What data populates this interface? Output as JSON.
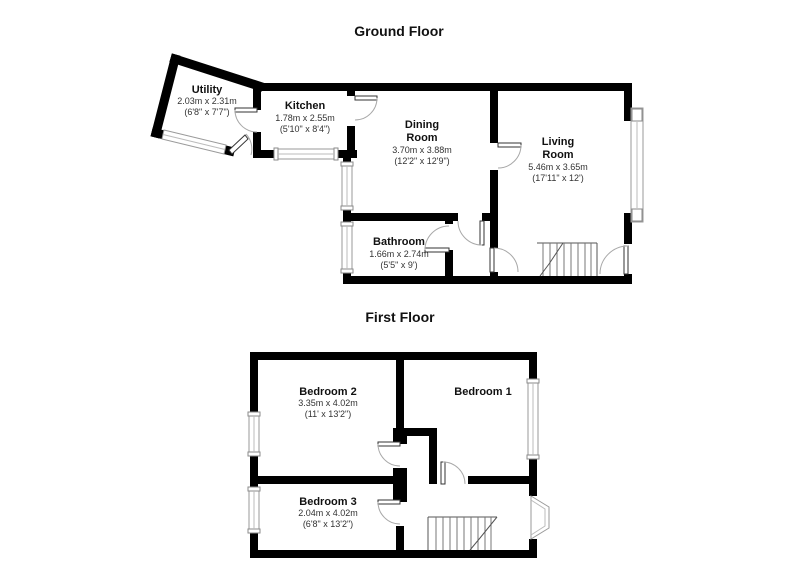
{
  "page": {
    "background": "#ffffff"
  },
  "colors": {
    "wall": "#000000",
    "window_outline": "#9a9a9a",
    "door_arc": "#a8a8a8",
    "stairs": "#555555",
    "room_name_text": "#111111",
    "dimension_text": "#333333"
  },
  "ground_floor": {
    "title": "Ground Floor",
    "rooms": {
      "utility": {
        "name": "Utility",
        "metric": "2.03m x 2.31m",
        "imperial": "(6'8\" x 7'7\")"
      },
      "kitchen": {
        "name": "Kitchen",
        "metric": "1.78m x 2.55m",
        "imperial": "(5'10\" x 8'4\")"
      },
      "dining": {
        "name_line1": "Dining",
        "name_line2": "Room",
        "metric": "3.70m x 3.88m",
        "imperial": "(12'2\" x 12'9\")"
      },
      "living": {
        "name_line1": "Living",
        "name_line2": "Room",
        "metric": "5.46m x 3.65m",
        "imperial": "(17'11\" x 12')"
      },
      "bathroom": {
        "name": "Bathroom",
        "metric": "1.66m x 2.74m",
        "imperial": "(5'5\" x 9')"
      }
    }
  },
  "first_floor": {
    "title": "First Floor",
    "rooms": {
      "bedroom2": {
        "name": "Bedroom 2",
        "metric": "3.35m x 4.02m",
        "imperial": "(11' x 13'2\")"
      },
      "bedroom1": {
        "name": "Bedroom 1"
      },
      "bedroom3": {
        "name": "Bedroom 3",
        "metric": "2.04m x 4.02m",
        "imperial": "(6'8\" x 13'2\")"
      }
    }
  }
}
